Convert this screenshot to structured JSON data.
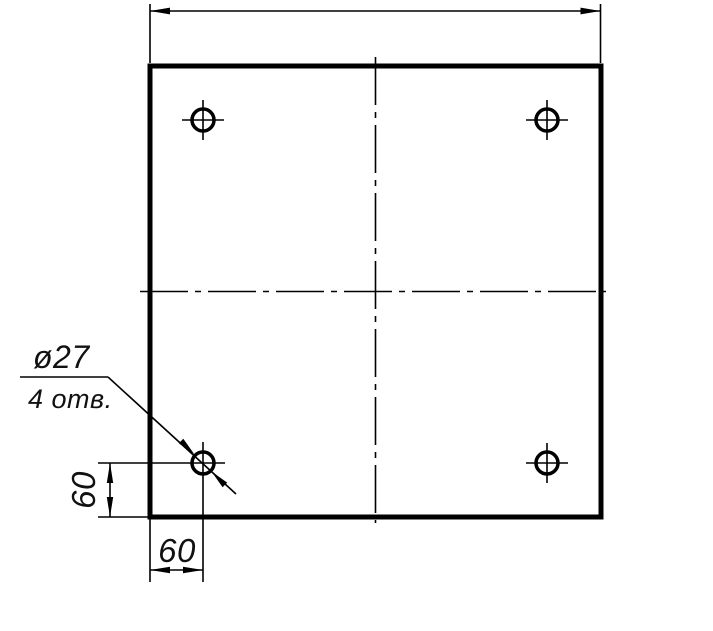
{
  "drawing": {
    "kind": "engineering-drawing",
    "view": "square plate, front view",
    "background_color": "#ffffff",
    "line_color": "#000000",
    "labels": {
      "hole_diameter": "ø27",
      "hole_count_note": "4 отв.",
      "dim_edge_offset_vertical": "60",
      "dim_edge_offset_horizontal": "60"
    },
    "part_data": {
      "holes": 4,
      "hole_diameter_mm": 27,
      "hole_offset_from_left_edge_mm": 60,
      "hole_offset_from_bottom_edge_mm": 60,
      "overall_width_dimension_shown": "unlabeled (arrows only, value cropped)"
    }
  }
}
